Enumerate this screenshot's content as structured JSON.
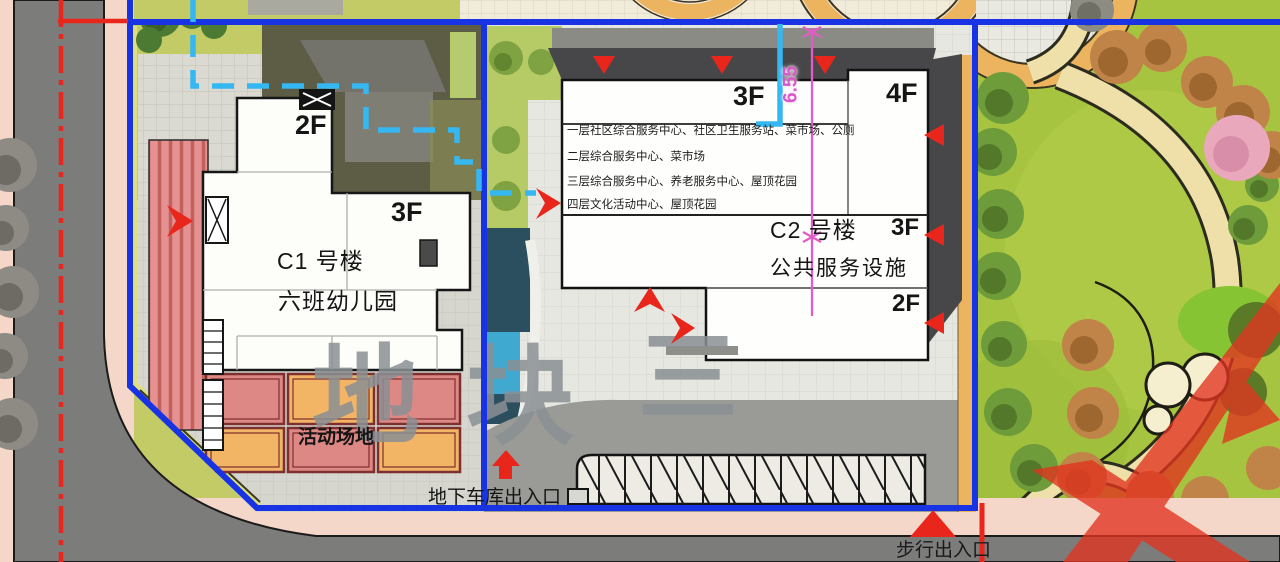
{
  "plan": {
    "watermark": [
      "地",
      "块",
      "三"
    ],
    "dimension": {
      "value": "6.55"
    },
    "buildings": {
      "c1": {
        "name": "C1 号楼",
        "subtitle": "六班幼儿园",
        "floors": {
          "wing": "2F",
          "main": "3F"
        }
      },
      "c2": {
        "name": "C2 号楼",
        "subtitle": "公共服务设施",
        "floors": {
          "header": "3F",
          "tower": "4F",
          "mid": "3F",
          "lower": "2F"
        },
        "notes": [
          "一层社区综合服务中心、社区卫生服务站、菜市场、公厕",
          "二层综合服务中心、菜市场",
          "三层综合服务中心、养老服务中心、屋顶花园",
          "四层文化活动中心、屋顶花园"
        ]
      }
    },
    "labels": {
      "playground": "活动场地",
      "garage_entrance": "地下车库出入口",
      "pedestrian_entrance": "步行出入口"
    },
    "colors": {
      "boundary_blue": "#1733e3",
      "annotation_red": "#e8261c",
      "utility_cyan": "#35b7f2",
      "dimension_magenta": "#e35cc5",
      "lawn_green": "#c3cb67",
      "park_green": "#a6c43f",
      "road_gray": "#7c7c7a",
      "sidewalk_pink": "#f4d7c9",
      "playground_red": "#dd8884",
      "playground_orange": "#f2b566"
    }
  }
}
